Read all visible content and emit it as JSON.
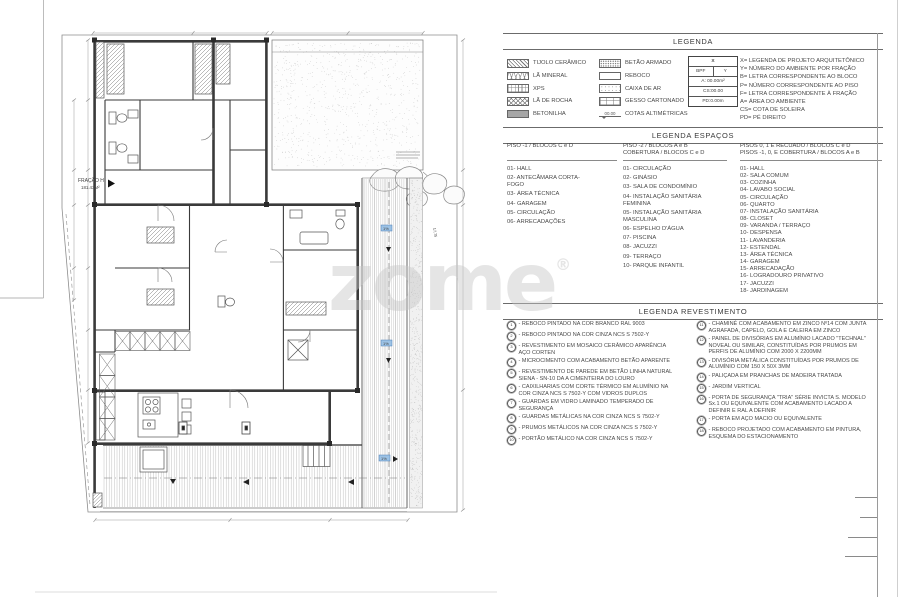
{
  "watermark": {
    "text": "zome",
    "registered": "®"
  },
  "colors": {
    "slope_marker_blue": "#9cc2e5",
    "drawing_line": "#3a3a3a"
  },
  "plan": {
    "fraction_label": "FRAÇÃO H",
    "fraction_area": "181.43M²",
    "slope_label": "1%",
    "dim_right": "17,75"
  },
  "legend": {
    "title": "LEGENDA",
    "materials_col1": [
      {
        "icon": "hatch-diagonal-swatch",
        "label": "TIJOLO CERÂMICO"
      },
      {
        "icon": "zigzag-swatch",
        "label": "LÃ MINERAL"
      },
      {
        "icon": "fine-grid-swatch",
        "label": "XPS"
      },
      {
        "icon": "diamond-hatch-swatch",
        "label": "LÃ DE ROCHA"
      },
      {
        "icon": "solid-gray-swatch",
        "label": "BETONILHA"
      }
    ],
    "materials_col2": [
      {
        "icon": "speckle-swatch",
        "label": "BETÃO ARMADO"
      },
      {
        "icon": "plain-swatch",
        "label": "REBOCO"
      },
      {
        "icon": "light-speckle-swatch",
        "label": "CAIXA DE AR"
      },
      {
        "icon": "cell-grid-swatch",
        "label": "GESSO CARTONADO"
      },
      {
        "icon": "level-mark-symbol",
        "label": "COTAS ALTIMÉTRICAS",
        "value": "00.00"
      }
    ],
    "tag_box": {
      "x": "X",
      "bpf": "BPF",
      "y": "Y",
      "area": "A: 00.00m²",
      "cs": "CS:00.00",
      "pd": "PD:0.00m"
    },
    "abbreviations": [
      "X= LEGENDA DE PROJETO ARQUITETÔNICO",
      "Y= NÚMERO DO AMBIENTE POR FRAÇÃO",
      "B= LETRA CORRESPONDENTE AO BLOCO",
      "P= NÚMERO CORRESPONDENTE AO PISO",
      "F= LETRA CORRESPONDENTE À FRAÇÃO",
      "A= ÁREA DO AMBIENTE",
      "CS= COTA DE SOLEIRA",
      "PD= PÉ DIREITO"
    ]
  },
  "spaces": {
    "title": "LEGENDA ESPAÇOS",
    "columns": [
      {
        "header": "PISO -1 / BLOCOS C e D",
        "items": [
          "01- HALL",
          "02- ANTECÂMARA CORTA-FOGO",
          "03- ÁREA TÉCNICA",
          "04- GARAGEM",
          "05- CIRCULAÇÃO",
          "06- ARRECADAÇÕES"
        ]
      },
      {
        "header": "PISO -2 / BLOCOS A e B\nCOBERTURA / BLOCOS C e D",
        "items": [
          "01- CIRCULAÇÃO",
          "02- GINÁSIO",
          "03- SALA DE CONDOMÍNIO",
          "04- INSTALAÇÃO SANITÁRIA FEMININA",
          "05- INSTALAÇÃO SANITÁRIA MASCULINA",
          "06- ESPELHO D'ÁGUA",
          "07- PISCINA",
          "08- JACUZZI",
          "09- TERRAÇO",
          "10- PARQUE INFANTIL"
        ]
      },
      {
        "header": "PISOS 0, 1 E RECUADO / BLOCOS C e D\nPISOS -1, 0, E COBERTURA / BLOCOS A e B",
        "items": [
          "01- HALL",
          "02- SALA COMUM",
          "03- COZINHA",
          "04- LAVABO SOCIAL",
          "05- CIRCULAÇÃO",
          "06- QUARTO",
          "07- INSTALAÇÃO SANITÁRIA",
          "08- CLOSET",
          "09- VARANDA / TERRAÇO",
          "10- DESPENSA",
          "11- LAVANDERIA",
          "12- ESTENDAL",
          "13- ÁREA TÉCNICA",
          "14- GARAGEM",
          "15- ARRECADAÇÃO",
          "16- LOGRADOURO PRIVATIVO",
          "17- JACUZZI",
          "18- JARDINAGEM"
        ]
      }
    ]
  },
  "finishes": {
    "title": "LEGENDA REVESTIMENTO",
    "col1": [
      {
        "n": "1",
        "t": "- REBOCO PINTADO NA COR BRANCO RAL 9003"
      },
      {
        "n": "2",
        "t": "- REBOCO PINTADO NA COR CINZA NCS S 7502-Y"
      },
      {
        "n": "3",
        "t": "- REVESTIMENTO EM MOSAICO CERÂMICO APARÊNCIA AÇO CORTEN"
      },
      {
        "n": "4",
        "t": "- MICROCIMENTO COM ACABAMENTO BETÃO APARENTE"
      },
      {
        "n": "5",
        "t": "- REVESTIMENTO DE PAREDE EM BETÃO LINHA NATURAL SIENA - SN-10 DA A CIMENTEIRA DO LOURO"
      },
      {
        "n": "6",
        "t": "- CAIXILHARIAS COM CORTE TÉRMICO EM ALUMÍNIO NA COR CINZA NCS S 7502-Y COM VIDROS DUPLOS"
      },
      {
        "n": "7",
        "t": "- GUARDAS EM VIDRO LAMINADO TEMPERADO DE SEGURANÇA"
      },
      {
        "n": "8",
        "t": "- GUARDAS METÁLICAS NA COR CINZA NCS S 7502-Y"
      },
      {
        "n": "9",
        "t": "- PRUMOS METÁLICOS NA COR CINZA NCS S 7502-Y"
      },
      {
        "n": "10",
        "t": "- PORTÃO METÁLICO NA COR CINZA NCS S 7502-Y"
      }
    ],
    "col2": [
      {
        "n": "11",
        "t": "- CHAMINÉ COM ACABAMENTO EM ZINCO Nº14 COM JUNTA AGRAFADA, CAPELO, GOLA E CALEIRA EM ZINCO"
      },
      {
        "n": "12",
        "t": "- PAINEL DE DIVISÓRIAS EM ALUMÍNIO LACADO \"TECHNAL\" NOVEAL OU SIMILAR, CONSTITUÍDAS POR PRUMOS EM PERFIS DE ALUMÍNIO COM 2000 X 2200MM"
      },
      {
        "n": "13",
        "t": "- DIVISÓRIA METÁLICA CONSTITUÍDAS POR PRUMOS DE ALUMÍNIO COM 150 X 50X 3MM"
      },
      {
        "n": "14",
        "t": "- PALIÇADA EM PRANCHAS DE MADEIRA TRATADA"
      },
      {
        "n": "15",
        "t": "- JARDIM VERTICAL"
      },
      {
        "n": "16",
        "t": "- PORTA DE SEGURANÇA \"TRIA\" SÉRIE INVICTA S. MODELO Sx.1 OU EQUIVALENTE COM ACABAMENTO LACADO A DEFINIR E RAL A DEFINIR"
      },
      {
        "n": "17",
        "t": "- PORTA EM AÇO MACIO OU EQUIVALENTE"
      },
      {
        "n": "18",
        "t": "- REBOCO PROJETADO COM ACABAMENTO EM PINTURA, ESQUEMA DO ESTACIONAMENTO"
      }
    ]
  }
}
